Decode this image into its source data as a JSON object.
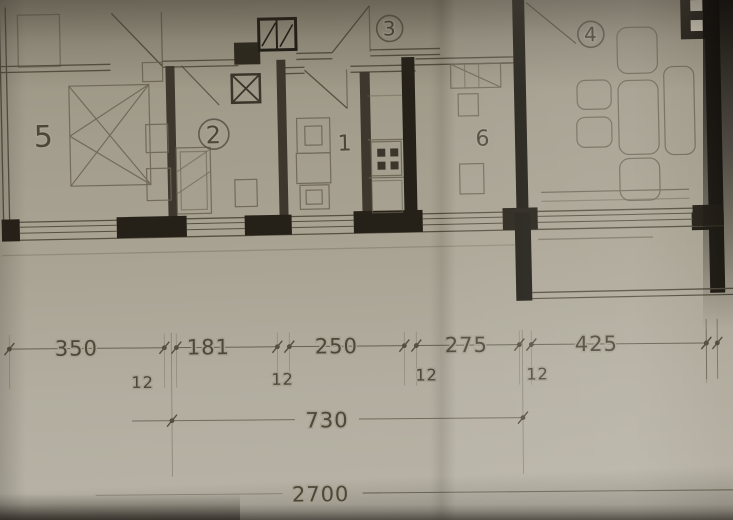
{
  "document": {
    "kind": "scanned apartment floor plan photograph",
    "units": "cm"
  },
  "colors": {
    "paper": "#a8a293",
    "ink": "#544e3e",
    "ink_soft": "#6e6857",
    "wall_dark": "#3b352a",
    "wall_black": "#1c1812",
    "text": "#4b4536",
    "white_box": "#cfc9ba"
  },
  "room_labels": [
    {
      "label": "5",
      "x": 44,
      "y": 140,
      "size": 30,
      "circled": false
    },
    {
      "label": "2",
      "x": 214,
      "y": 140,
      "size": 24,
      "circled": true,
      "r": 15
    },
    {
      "label": "1",
      "x": 345,
      "y": 150,
      "size": 22,
      "circled": false
    },
    {
      "label": "3",
      "x": 392,
      "y": 36,
      "size": 20,
      "circled": true,
      "r": 13
    },
    {
      "label": "6",
      "x": 483,
      "y": 148,
      "size": 22,
      "circled": false
    },
    {
      "label": "4",
      "x": 593,
      "y": 46,
      "size": 20,
      "circled": true,
      "r": 13
    }
  ],
  "dimensions": {
    "row1": {
      "y": 346,
      "segments": [
        {
          "value": "350",
          "x1": 10,
          "x2": 165,
          "tx": 77
        },
        {
          "value": "181",
          "x1": 177,
          "x2": 278,
          "tx": 209
        },
        {
          "value": "250",
          "x1": 290,
          "x2": 405,
          "tx": 337
        },
        {
          "value": "275",
          "x1": 417,
          "x2": 520,
          "tx": 467
        },
        {
          "value": "425",
          "x1": 532,
          "x2": 707,
          "tx": 597
        }
      ],
      "end_ticks": [
        707,
        718
      ]
    },
    "thickness_labels": [
      {
        "value": "12",
        "x": 143,
        "y": 386
      },
      {
        "value": "12",
        "x": 283,
        "y": 384
      },
      {
        "value": "12",
        "x": 427,
        "y": 381
      },
      {
        "value": "12",
        "x": 538,
        "y": 381
      }
    ],
    "row2": {
      "value": "730",
      "x1": 172,
      "x2": 523,
      "y": 419,
      "tx": 327
    },
    "row3": {
      "value": "2700",
      "x1": 95,
      "x2": 733,
      "y": 493,
      "tx": 320
    }
  }
}
